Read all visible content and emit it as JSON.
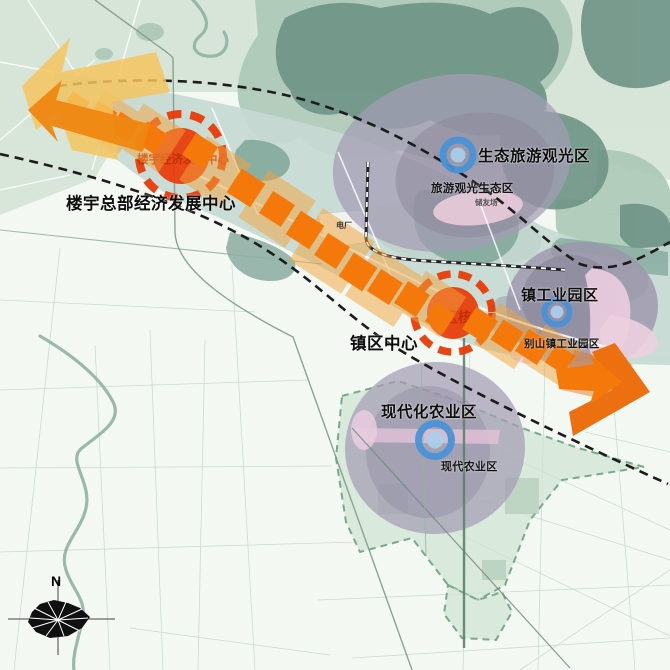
{
  "zones": [
    {
      "id": "tower-hq-economy",
      "title": "楼宇总部经济发展中心",
      "circle_label": "楼宇经济发展中心"
    },
    {
      "id": "town-center",
      "title": "镇区中心",
      "circle_label": "镇区核心"
    },
    {
      "id": "eco-tourism",
      "title": "生态旅游观光区",
      "area_label": "旅游观光生态区"
    },
    {
      "id": "town-industry",
      "title": "镇工业园区",
      "area_label": "别山镇工业园区"
    },
    {
      "id": "modern-agriculture",
      "title": "现代化农业区",
      "area_label": "现代农业区"
    }
  ],
  "map_labels": {
    "power_plant": "电厂",
    "site": "储友场"
  },
  "compass": {
    "north": "N"
  },
  "colors": {
    "axis_orange": "#f5790a",
    "axis_pale_orange": "#f2a43c",
    "start_arrow_yellow": "#f5c45e",
    "start_arrow_orange": "#ee8711",
    "center_red": "#e93a06",
    "marker_blue": "#4792d8",
    "zone_purple": "#a49cb4",
    "zone_pink": "#e8cade",
    "forest_green": "#6e9486",
    "corridor_teal": "#7ba295",
    "map_pale_green": "#d6e5d8",
    "dashed_line": "#1c1c1c"
  }
}
